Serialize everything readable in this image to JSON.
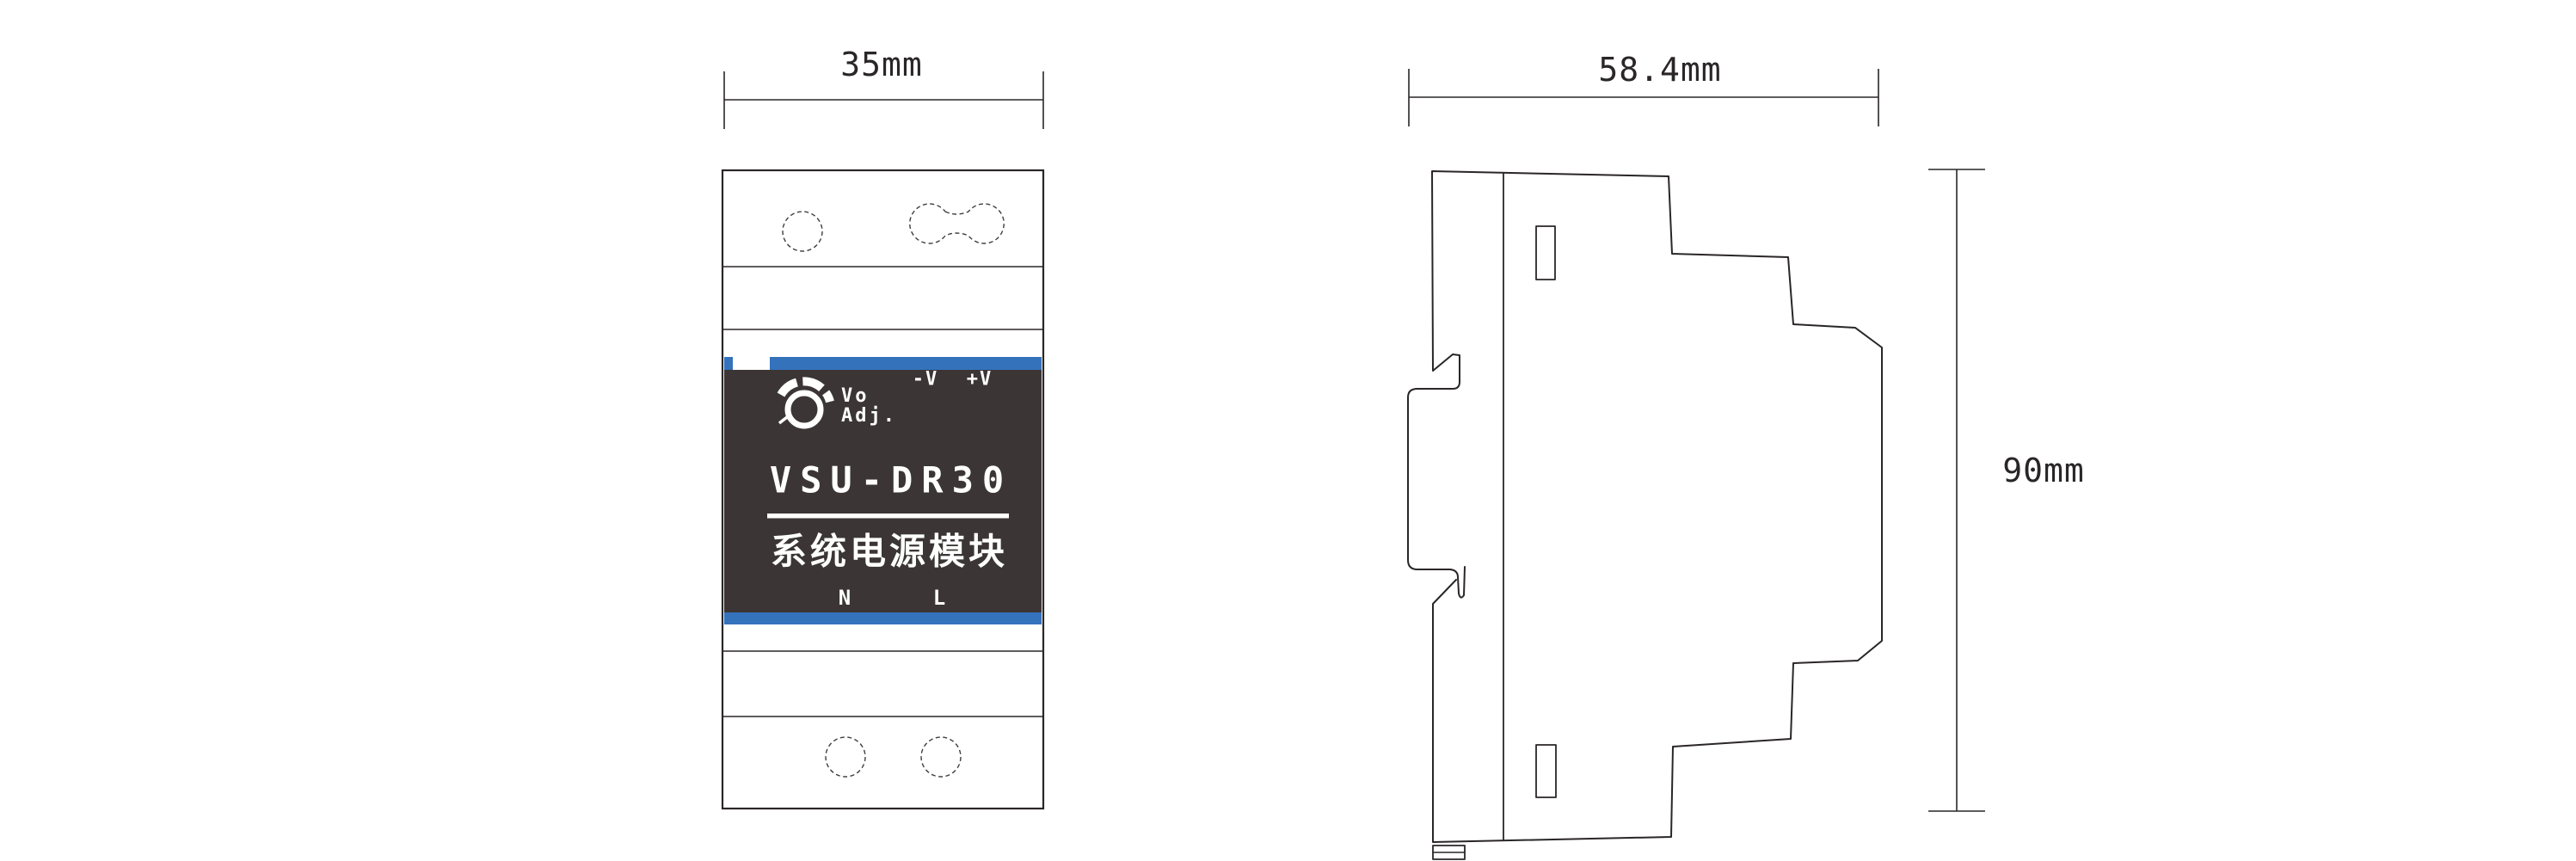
{
  "drawing": {
    "title_semantic": "DIN rail power module dimension drawing",
    "front_view": {
      "width_dim": "35mm",
      "model": "VSU-DR30",
      "subtitle": "系统电源模块",
      "knob_label_line1": "Vo",
      "knob_label_line2": "Adj.",
      "terminal_neg": "-V",
      "terminal_pos": "+V",
      "terminal_neutral": "N",
      "terminal_live": "L"
    },
    "side_view": {
      "depth_dim": "58.4mm",
      "height_dim": "90mm"
    },
    "colors": {
      "accent_blue": "#3472bc",
      "label_dark": "#3b3635",
      "line": "#2a2627",
      "text_on_label": "#ffffff"
    }
  }
}
